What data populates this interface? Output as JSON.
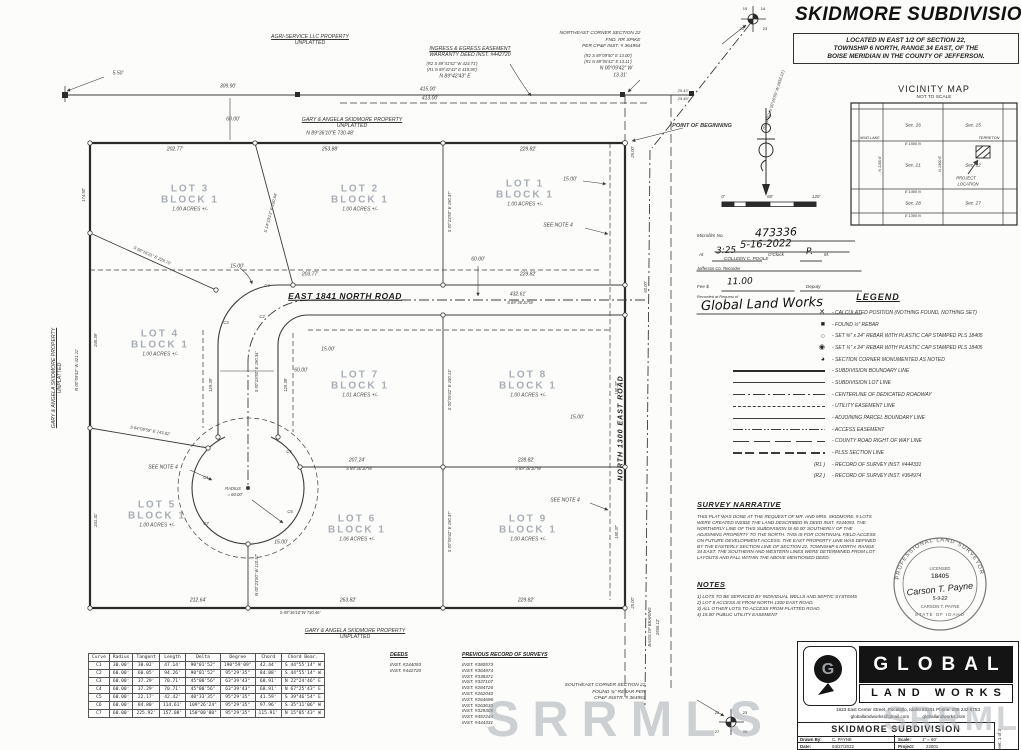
{
  "title": {
    "main": "SKIDMORE SUBDIVISION",
    "sub1": "LOCATED IN EAST 1/2 OF SECTION 22,",
    "sub2": "TOWNSHIP 6 NORTH, RANGE 34 EAST, OF THE",
    "sub3": "BOISE MERIDIAN IN THE COUNTY OF JEFFERSON."
  },
  "vicinity": {
    "heading": "VICINITY MAP",
    "scale_note": "NOT TO SCALE",
    "labels": [
      {
        "t": "Sec. 16",
        "x": 63,
        "y": 23
      },
      {
        "t": "Sec. 15",
        "x": 123,
        "y": 23
      },
      {
        "t": "MUD LAKE",
        "x": 20,
        "y": 36,
        "s": 3.8
      },
      {
        "t": "TERRETON",
        "x": 139,
        "y": 36,
        "s": 3.8
      },
      {
        "t": "E 1500 N",
        "x": 63,
        "y": 42,
        "s": 3.8
      },
      {
        "t": "N 1100 E",
        "x": 30,
        "y": 62,
        "r": -90,
        "s": 3.8
      },
      {
        "t": "N 1300 E",
        "x": 90,
        "y": 62,
        "r": -90,
        "s": 3.8
      },
      {
        "t": "Sec. 21",
        "x": 63,
        "y": 63
      },
      {
        "t": "Sec. 22",
        "x": 123,
        "y": 63
      },
      {
        "t": "PROJECT",
        "x": 116,
        "y": 76,
        "s": 4.2
      },
      {
        "t": "LOCATION",
        "x": 118,
        "y": 82,
        "s": 4.2
      },
      {
        "t": "E 1400 N",
        "x": 63,
        "y": 90,
        "s": 3.8
      },
      {
        "t": "Sec. 28",
        "x": 63,
        "y": 101
      },
      {
        "t": "Sec. 27",
        "x": 123,
        "y": 101
      },
      {
        "t": "E 1300 N",
        "x": 63,
        "y": 114,
        "s": 3.8
      }
    ]
  },
  "recorder": {
    "microfilm_label": "Microfilm No.",
    "microfilm": "473336",
    "date": "5-16-2022",
    "at_label": "At",
    "time": "3:25",
    "oclock_label": "O'Clock",
    "ampm": "P.",
    "m_label": "M.",
    "recorder_name": "COLLEEN C. POOLE",
    "recorder_title": "Jefferson Co. Recorder",
    "fee_label": "Fee $",
    "fee": "11.00",
    "deputy_label": "Deputy",
    "request_label": "Recorded at Request of",
    "requester": "Global Land Works"
  },
  "legend": {
    "heading": "LEGEND",
    "items": [
      {
        "glyph": "✕",
        "t": "- CALCULATED POSITION (NOTHING FOUND, NOTHING SET)"
      },
      {
        "glyph": "■",
        "t": "- FOUND ½\" REBAR"
      },
      {
        "glyph": "○",
        "t": "- SET ⅝\" x 24\" REBAR WITH PLASTIC CAP STAMPED PLS 18405"
      },
      {
        "glyph": "◉",
        "t": "- SET ¾\" x 24\" REBAR WITH PLASTIC CAP STAMPED PLS 18405"
      },
      {
        "glyph": "◕",
        "t": "- SECTION CORNER MONUMENTED AS NOTED"
      },
      {
        "line": "thick",
        "t": "- SUBDIVISION BOUNDARY LINE"
      },
      {
        "line": "solid",
        "t": "- SUBDIVISION LOT LINE"
      },
      {
        "line": "dashdot",
        "t": "- CENTERLINE OF DEDICATED ROADWAY"
      },
      {
        "line": "dash",
        "t": "- UTILITY EASEMENT LINE"
      },
      {
        "line": "med",
        "t": "- ADJOINING PARCEL BOUNDARY LINE"
      },
      {
        "line": "dashdotdot",
        "t": "- ACCESS EASEMENT"
      },
      {
        "line": "longdash",
        "t": "- COUNTY ROAD RIGHT OF WAY LINE"
      },
      {
        "line": "plss",
        "t": "- PLSS SECTION LINE"
      },
      {
        "sym": "(R1 )",
        "t": "- RECORD OF SURVEY INST. #444331"
      },
      {
        "sym": "(R2 )",
        "t": "- RECORD OF SURVEY INST. #364974"
      }
    ]
  },
  "narrative": {
    "heading": "SURVEY NARRATIVE",
    "lines": [
      "THIS PLAT WAS DONE AT THE REQUEST OF MR. AND MRS. SKIDMORE.  9 LOTS",
      "WERE CREATED INSIDE THE LAND DESCRIBED IN DEED INST. #244093.  THE",
      "NORTHERLY LINE OF THIS SUBDIVISION IS 60.00' SOUTHERLY OF THE",
      "ADJOINING PROPERTY TO THE NORTH.  THIS IS FOR CONTINUAL FIELD ACCESS",
      "ON FUTURE DEVELOPMENT ACCESS.  THE EAST PROPERTY LINE WAS DEFINED",
      "BY THE EASTERLY SECTION LINE OF SECTION 22, TOWNSHIP 6 NORTH, RANGE",
      "34 EAST.  THE SOUTHERN AND WESTERN LINES WERE DETERMINED FROM LOT",
      "LAYOUTS AND FALL WITHIN THE ABOVE MENTIONED DEED."
    ]
  },
  "notes": {
    "heading": "NOTES",
    "items": [
      "1) LOTS TO BE SERVICED BY INDIVIDUAL WELLS AND SEPTIC SYSTEMS",
      "2) LOT 8 ACCESS IS FROM NORTH 1300 EAST ROAD.",
      "3) ALL OTHER LOTS TO ACCESS FROM PLATTED ROAD",
      "4) 15.00' PUBLIC UTILITY EASEMENT"
    ]
  },
  "stamp": {
    "arc_top": "PROFESSIONAL LAND SURVEYOR",
    "licensed": "LICENSED",
    "number": "18405",
    "sig": "Carson T. Payne",
    "sig_date": "5-9-22",
    "name": "CARSON T. PAYNE",
    "state": "STATE OF IDAHO"
  },
  "firm": {
    "brand_top": "GLOBAL",
    "brand_bottom": "LAND WORKS",
    "address": "1823 East Center Street, Pocatello, Idaho 83201  Phone: 208 242 8753",
    "email": "globallandworks@gmail.com",
    "website": "globallandworks.com",
    "project_title": "SKIDMORE SUBDIVISION",
    "drawn_by_label": "Drawn By:",
    "drawn_by": "C. PAYNE",
    "date_label": "Date:",
    "date": "04/27/2022",
    "scale_label": "Scale:",
    "scale": "1\" = 60'",
    "project_label": "Project:",
    "project": "22001",
    "sheet": "Sheet:  1 of 3"
  },
  "scalebar": {
    "labels": [
      {
        "t": "0'",
        "x": 723,
        "y": 197,
        "s": 4.5
      },
      {
        "t": "60'",
        "x": 770,
        "y": 197,
        "s": 4.5
      },
      {
        "t": "120'",
        "x": 816,
        "y": 197,
        "s": 4.5
      }
    ]
  },
  "curve_table": {
    "headers": [
      "Curve",
      "Radius",
      "Tangent",
      "Length",
      "Delta",
      "Degree",
      "Chord",
      "Chord Bear."
    ],
    "rows": [
      [
        "C1",
        "30.00'",
        "30.02'",
        "47.14'",
        "90°01'52\"",
        "190°59'09\"",
        "42.44'",
        "S 44°55'14\" W"
      ],
      [
        "C2",
        "60.00'",
        "60.05'",
        "94.26'",
        "90°01'52\"",
        "95°29'35\"",
        "84.88'",
        "S 44°55'14\" W"
      ],
      [
        "C3",
        "60.00'",
        "37.29'",
        "70.71'",
        "45°00'56\"",
        "63°39'43\"",
        "68.91'",
        "N 22°24'46\" E"
      ],
      [
        "C4",
        "60.00'",
        "37.29'",
        "70.71'",
        "45°00'56\"",
        "63°39'43\"",
        "68.91'",
        "N 67°25'43\" E"
      ],
      [
        "C5",
        "60.00'",
        "22.17'",
        "42.42'",
        "40°33'35\"",
        "95°29'35\"",
        "41.59'",
        "S 39°46'54\" E"
      ],
      [
        "C6",
        "60.00'",
        "84.80'",
        "114.61'",
        "109°26'24\"",
        "95°29'35\"",
        "97.96'",
        "S 35°11'06\" W"
      ],
      [
        "C7",
        "60.00'",
        "225.92'",
        "157.08'",
        "150°00'00\"",
        "95°29'35\"",
        "115.91'",
        "N 15°05'43\" W"
      ]
    ]
  },
  "deeds": {
    "heading": "DEEDS",
    "items": [
      "INST. #244093",
      "INST. #442720"
    ]
  },
  "surveys": {
    "heading": "PREVIOUS RECORD OF SURVEYS",
    "items": [
      "INST. #380573",
      "INST. #364974",
      "INST. #338471",
      "INST. #337107",
      "INST. #284726",
      "INST. #262040",
      "INST. #264696",
      "INST. #263633",
      "INST. #329309",
      "INST. #457244",
      "INST. #444331"
    ]
  },
  "corner_notes": [
    {
      "l1": "NORTHEAST CORNER SECTION 22",
      "l2": "FND. RR SPIKE",
      "l3": "PER CP&F INST. # 364954",
      "x": 600,
      "y": 41
    },
    {
      "l1": "SOUTHEAST CORNER SECTION 22",
      "l2": "FOUND ¾\" REBAR PER",
      "l3": "CP&F INSTR. # 364953",
      "x": 605,
      "y": 693
    }
  ],
  "props": [
    {
      "l1": "AGRI-SERVICE LLC PROPERTY",
      "l2": "UNPLATTED",
      "x": 310,
      "y": 40
    },
    {
      "l1": "GARY & ANGELA SKIDMORE PROPERTY",
      "l2": "UNPLATTED",
      "x": 352,
      "y": 123
    },
    {
      "l1": "GARY & ANGELA SKIDMORE PROPERTY",
      "l2": "UNPLATTED",
      "x": 355,
      "y": 634
    },
    {
      "l1": "GARY & ANGELA SKIDMORE PROPERTY",
      "l2": "UNPLATTED",
      "x": 57,
      "y": 378,
      "r": -90
    },
    {
      "l1": "INGRESS & EGRESS EASEMENT",
      "l2": "WARRANTY DEED INST. #442720",
      "x": 470,
      "y": 52
    }
  ],
  "lots": [
    {
      "name": "LOT 1",
      "block": "BLOCK 1",
      "acres": "1.00 ACRES +/-",
      "x": 525,
      "y": 193
    },
    {
      "name": "LOT 2",
      "block": "BLOCK 1",
      "acres": "1.00 ACRES +/-",
      "x": 360,
      "y": 198
    },
    {
      "name": "LOT 3",
      "block": "BLOCK 1",
      "acres": "1.00 ACRES +/-",
      "x": 190,
      "y": 198
    },
    {
      "name": "LOT 4",
      "block": "BLOCK 1",
      "acres": "1.00 ACRES +/-",
      "x": 160,
      "y": 343
    },
    {
      "name": "LOT 5",
      "block": "BLOCK 1",
      "acres": "1.00 ACRES +/-",
      "x": 157,
      "y": 514
    },
    {
      "name": "LOT 6",
      "block": "BLOCK 1",
      "acres": "1.06 ACRES +/-",
      "x": 357,
      "y": 528
    },
    {
      "name": "LOT 7",
      "block": "BLOCK 1",
      "acres": "1.01 ACRES +/-",
      "x": 360,
      "y": 384
    },
    {
      "name": "LOT 8",
      "block": "BLOCK 1",
      "acres": "1.00 ACRES +/-",
      "x": 528,
      "y": 384
    },
    {
      "name": "LOT 9",
      "block": "BLOCK 1",
      "acres": "1.00 ACRES +/-",
      "x": 528,
      "y": 528
    }
  ],
  "roads": {
    "east": "EAST 1841 NORTH ROAD",
    "north": "NORTH 1300 EAST ROAD"
  },
  "pob": "POINT OF BEGINNING",
  "dims": [
    {
      "t": "5.50'",
      "x": 118,
      "y": 74
    },
    {
      "t": "309.90'",
      "x": 228,
      "y": 87
    },
    {
      "t": "60.00'",
      "x": 233,
      "y": 120
    },
    {
      "t": "(R2 S 89°09'50\" E  13.00')",
      "x": 608,
      "y": 56,
      "s": 4.2
    },
    {
      "t": "(R1 N 89°05'42\" E  13.11')",
      "x": 608,
      "y": 62,
      "s": 4.2
    },
    {
      "t": "N 00°09'42\" W",
      "x": 616,
      "y": 69
    },
    {
      "t": "13.31'",
      "x": 620,
      "y": 76
    },
    {
      "t": "(R2 S 89°41'52\" W  424.71')",
      "x": 452,
      "y": 64,
      "s": 4.2
    },
    {
      "t": "(R1 N 89°42'43\" E  419.95')",
      "x": 452,
      "y": 70,
      "s": 4.2
    },
    {
      "t": "N 89°42'43\" E",
      "x": 455,
      "y": 77
    },
    {
      "t": "415.00'",
      "x": 428,
      "y": 90
    },
    {
      "t": "413.00'",
      "x": 430,
      "y": 99
    },
    {
      "t": "25.43'",
      "x": 683,
      "y": 91,
      "s": 4
    },
    {
      "t": "25.49'",
      "x": 683,
      "y": 99,
      "s": 4
    },
    {
      "t": "(R1 & R2: N 00°26'50\" W  2656.12')",
      "x": 774,
      "y": 100,
      "r": -72,
      "s": 4
    },
    {
      "t": "N 89°36'10\"E  730.48'",
      "x": 330,
      "y": 134
    },
    {
      "t": "202.77'",
      "x": 175,
      "y": 150
    },
    {
      "t": "253.88'",
      "x": 330,
      "y": 150
    },
    {
      "t": "229.82'",
      "x": 528,
      "y": 150
    },
    {
      "t": "25.00'",
      "x": 633,
      "y": 152,
      "r": -90,
      "s": 4.2
    },
    {
      "t": "60.00'",
      "x": 646,
      "y": 287,
      "r": -90,
      "s": 4.2
    },
    {
      "t": "15.00'",
      "x": 570,
      "y": 180
    },
    {
      "t": "SEE NOTE 4",
      "x": 558,
      "y": 226
    },
    {
      "t": "S 14°10'13\" E  190.94'",
      "x": 271,
      "y": 213,
      "r": -75,
      "s": 4.2
    },
    {
      "t": "S 56°16'21\" E  229.70'",
      "x": 152,
      "y": 256,
      "r": 24,
      "s": 4.2
    },
    {
      "t": "15.00'",
      "x": 237,
      "y": 267
    },
    {
      "t": "203.77'",
      "x": 310,
      "y": 275
    },
    {
      "t": "229.82'",
      "x": 528,
      "y": 275
    },
    {
      "t": "60.00'",
      "x": 478,
      "y": 260
    },
    {
      "t": "432.61'",
      "x": 518,
      "y": 295
    },
    {
      "t": "S 89°36'10\"W",
      "x": 520,
      "y": 303,
      "s": 4.2
    },
    {
      "t": "S 00°23'50\" E  190.37'",
      "x": 450,
      "y": 212,
      "r": -90,
      "s": 4.2
    },
    {
      "t": "15.00'",
      "x": 328,
      "y": 350
    },
    {
      "t": "60.00'",
      "x": 301,
      "y": 371
    },
    {
      "t": "129.39'",
      "x": 211,
      "y": 385,
      "r": -90,
      "s": 4.2
    },
    {
      "t": "129.39'",
      "x": 286,
      "y": 385,
      "r": -90,
      "s": 4.2
    },
    {
      "t": "S 00°23'50\" E  190.34'",
      "x": 257,
      "y": 372,
      "r": -90,
      "s": 4.2
    },
    {
      "t": "S 00°09'42\" E  190.13'",
      "x": 450,
      "y": 390,
      "r": -90,
      "s": 4.2
    },
    {
      "t": "190.37'",
      "x": 617,
      "y": 388,
      "r": -90,
      "s": 4.2
    },
    {
      "t": "15.00'",
      "x": 577,
      "y": 418
    },
    {
      "t": "S 64°09'59\" E  143.82'",
      "x": 150,
      "y": 431,
      "r": 10,
      "s": 4.2
    },
    {
      "t": "SEE NOTE 4",
      "x": 163,
      "y": 468
    },
    {
      "t": "RADIUS",
      "x": 233,
      "y": 489,
      "s": 4.2
    },
    {
      "t": "= 60.00'",
      "x": 235,
      "y": 495,
      "s": 4.2
    },
    {
      "t": "207.24'",
      "x": 357,
      "y": 461
    },
    {
      "t": "S 89°36'10\"W",
      "x": 359,
      "y": 469,
      "s": 4.2
    },
    {
      "t": "228.82'",
      "x": 526,
      "y": 461
    },
    {
      "t": "S 89°36'10\"W",
      "x": 528,
      "y": 469,
      "s": 4.2
    },
    {
      "t": "SEE NOTE 4",
      "x": 565,
      "y": 501
    },
    {
      "t": "15.00'",
      "x": 281,
      "y": 543
    },
    {
      "t": "N 00°23'50\" W  110.57'",
      "x": 257,
      "y": 575,
      "r": -90,
      "s": 4.2
    },
    {
      "t": "S 00°09'42\" E  190.37'",
      "x": 450,
      "y": 532,
      "r": -90,
      "s": 4.2
    },
    {
      "t": "190.37'",
      "x": 617,
      "y": 532,
      "r": -90,
      "s": 4.2
    },
    {
      "t": "212.64'",
      "x": 198,
      "y": 601
    },
    {
      "t": "263.82'",
      "x": 348,
      "y": 601
    },
    {
      "t": "229.82'",
      "x": 526,
      "y": 601
    },
    {
      "t": "S 89°36'10\"W  730.46'",
      "x": 300,
      "y": 613,
      "s": 4.2
    },
    {
      "t": "25.00'",
      "x": 633,
      "y": 603,
      "r": -90,
      "s": 4.2
    },
    {
      "t": "174.50'",
      "x": 84,
      "y": 195,
      "r": -90,
      "s": 4.2
    },
    {
      "t": "245.39'",
      "x": 96,
      "y": 340,
      "r": -90,
      "s": 4.2
    },
    {
      "t": "N 00°09'42\" W  421.11'",
      "x": 77,
      "y": 370,
      "r": -90,
      "s": 4.2
    },
    {
      "t": "241.31'",
      "x": 96,
      "y": 520,
      "r": -90,
      "s": 4.2
    },
    {
      "t": "BASIS OF BEARING",
      "x": 650,
      "y": 627,
      "r": -90,
      "s": 4.2
    },
    {
      "t": "2656.12'",
      "x": 658,
      "y": 627,
      "r": -90,
      "s": 4.2
    },
    {
      "t": "C1",
      "x": 206,
      "y": 478,
      "s": 4.2
    },
    {
      "t": "C2",
      "x": 262,
      "y": 317,
      "s": 4.2
    },
    {
      "t": "C3",
      "x": 226,
      "y": 323,
      "s": 4.2
    },
    {
      "t": "C4",
      "x": 267,
      "y": 286,
      "s": 4.2
    },
    {
      "t": "C5",
      "x": 289,
      "y": 452,
      "s": 4.2
    },
    {
      "t": "C6",
      "x": 290,
      "y": 512,
      "s": 4.2
    },
    {
      "t": "C7",
      "x": 206,
      "y": 524,
      "s": 4.2
    },
    {
      "t": "EAST 1841 NORTH ROAD",
      "x": 345,
      "y": 296,
      "c": "road"
    },
    {
      "t": "NORTH 1300 EAST ROAD",
      "x": 621,
      "y": 428,
      "r": -90,
      "c": "road2"
    },
    {
      "t": "POINT OF BEGINNING",
      "x": 702,
      "y": 127,
      "c": "pob"
    },
    {
      "t": "15",
      "x": 745,
      "y": 9,
      "s": 4,
      "c": "secnum"
    },
    {
      "t": "14",
      "x": 763,
      "y": 9,
      "s": 4,
      "c": "secnum"
    },
    {
      "t": "22",
      "x": 742,
      "y": 29,
      "s": 4,
      "c": "secnum"
    },
    {
      "t": "23",
      "x": 765,
      "y": 29,
      "s": 4,
      "c": "secnum"
    },
    {
      "t": "22",
      "x": 717,
      "y": 713,
      "s": 4,
      "c": "secnum"
    },
    {
      "t": "23",
      "x": 745,
      "y": 713,
      "s": 4,
      "c": "secnum"
    },
    {
      "t": "27",
      "x": 717,
      "y": 732,
      "s": 4,
      "c": "secnum"
    },
    {
      "t": "26",
      "x": 745,
      "y": 732,
      "s": 4,
      "c": "secnum"
    }
  ],
  "rules": [
    {
      "x": 800,
      "y": 241,
      "w": 110
    },
    {
      "x": 782,
      "y": 252,
      "w": 135
    },
    {
      "x": 737,
      "y": 261,
      "w": 50
    },
    {
      "x": 811,
      "y": 261,
      "w": 22
    },
    {
      "x": 779,
      "y": 271,
      "w": 165
    },
    {
      "x": 758,
      "y": 291,
      "w": 73
    },
    {
      "x": 831,
      "y": 291,
      "w": 62
    },
    {
      "x": 779,
      "y": 314,
      "w": 165
    }
  ],
  "watermark": "SRRMLS",
  "colors": {
    "ink": "#3c3c3c",
    "lot_label": "#a8aeb6",
    "watermark": "#a7adb3",
    "brand_black": "#141414"
  }
}
